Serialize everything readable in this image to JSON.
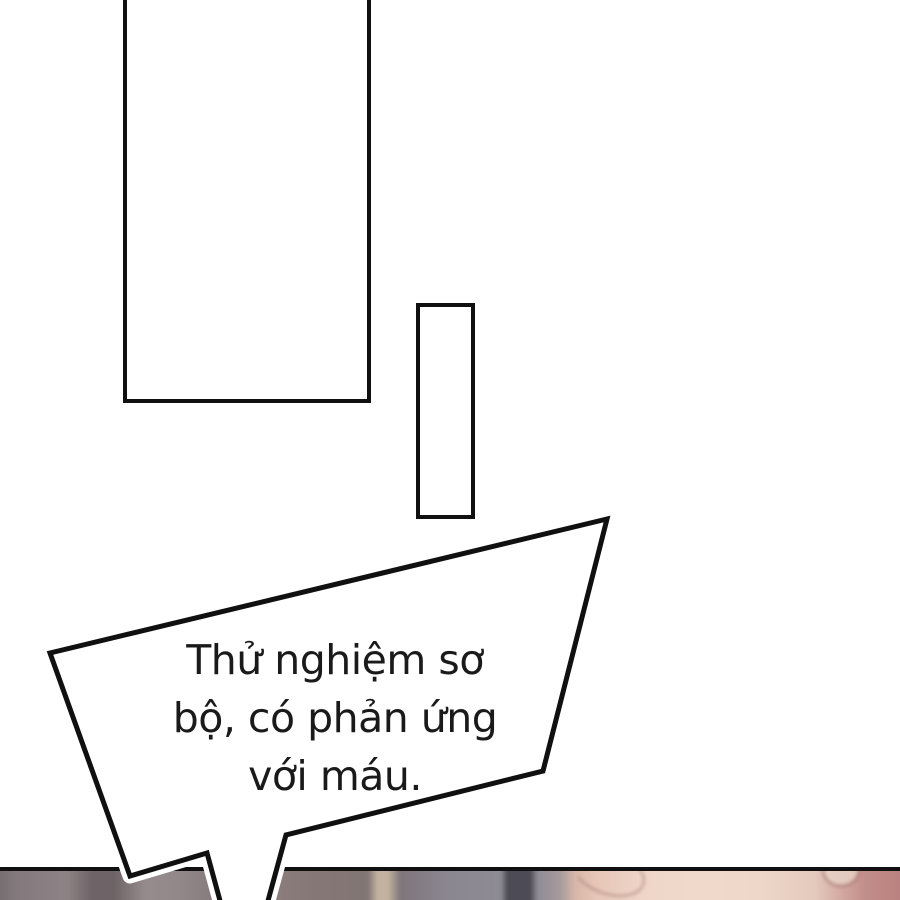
{
  "page": {
    "background": "#ffffff",
    "ink_color": "#101010"
  },
  "speech_bubble": {
    "full_text": "Thử nghiệm sơ bộ, có phản ứng với máu.",
    "lines": [
      "Thử nghiệm sơ",
      "bộ, có phản ứng",
      "với máu."
    ],
    "fill": "#ffffff",
    "stroke": "#101010",
    "text_color": "#1a1a1a"
  },
  "bottom_scene": {
    "border_color": "#101010",
    "palette": {
      "left_gray": "#8a8083",
      "dark_streak": "#6e6366",
      "beige_streak": "#c2b29f",
      "blue_gray": "#8e8b95",
      "dark_bar": "#4d4b55",
      "skin_light": "#f0d9cb",
      "skin_mid": "#e6c6b7",
      "skin_red": "#c28e8a"
    }
  }
}
